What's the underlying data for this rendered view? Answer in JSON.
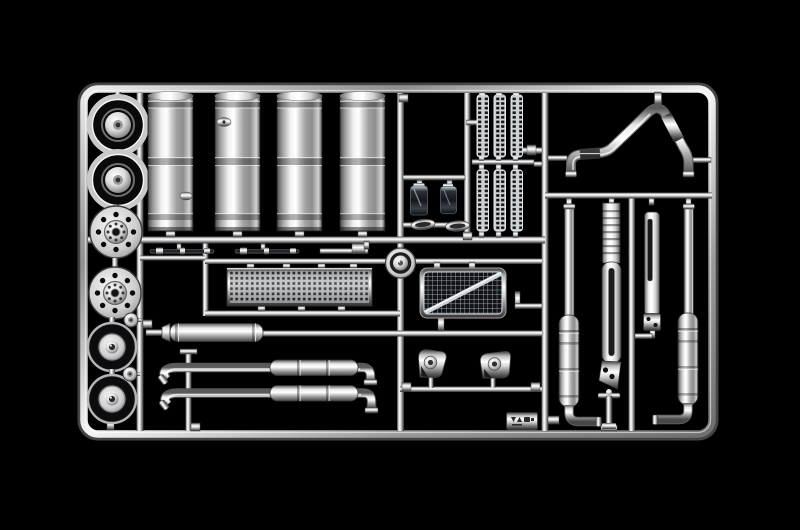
{
  "scene": {
    "type": "photograph",
    "subject": "Chrome-plated injection-moulded model kit sprue (truck detail parts) on a black background",
    "orientation": "overhead, sprue horizontal",
    "lighting": "studio specular highlights on mirror chrome"
  },
  "palette": {
    "background": "#000000",
    "chrome_highlight": "#ffffff",
    "chrome_mid": "#c2c2c2",
    "chrome_shadow": "#3a3a3a",
    "dark_part": "#15161a"
  },
  "parts": [
    {
      "label": "Sprue frame and runners",
      "count": 1,
      "position": "outer rounded rectangle with internal rails"
    },
    {
      "label": "Front wheel covers",
      "count": 2,
      "position": "left column, top"
    },
    {
      "label": "Perforated brake hub covers",
      "count": 2,
      "position": "left column, middle"
    },
    {
      "label": "Rear wheel trims with tyre ring",
      "count": 2,
      "position": "left column, bottom"
    },
    {
      "label": "Small hub caps",
      "count": 2,
      "position": "left column, between lower wheels"
    },
    {
      "label": "Cylindrical fuel tanks",
      "count": 4,
      "position": "upper centre"
    },
    {
      "label": "Perforated exhaust heat-shield strips",
      "count": 6,
      "position": "upper centre-right, two rows of three"
    },
    {
      "label": "Cab step panels",
      "count": 2,
      "position": "centre, dark rectangular parts"
    },
    {
      "label": "Lamp lenses",
      "count": 2,
      "position": "centre, below step panels"
    },
    {
      "label": "Tank end cap",
      "count": 1,
      "position": "centre, round disc"
    },
    {
      "label": "Perforated catwalk plate",
      "count": 1,
      "position": "centre-left band"
    },
    {
      "label": "Trim rods",
      "count": 2,
      "position": "above catwalk plate"
    },
    {
      "label": "Radiator grille with diagonal bar",
      "count": 1,
      "position": "centre, meshed rectangle"
    },
    {
      "label": "Horizontal silencer",
      "count": 1,
      "position": "lower left"
    },
    {
      "label": "Side exhaust pipes with mufflers",
      "count": 2,
      "position": "lower centre, long pipes with curved tips"
    },
    {
      "label": "Wing mirror housings",
      "count": 2,
      "position": "lower centre-right"
    },
    {
      "label": "Curved roof bar Y-pipe",
      "count": 1,
      "position": "upper right"
    },
    {
      "label": "Vertical exhaust stacks with bottom elbows",
      "count": 2,
      "position": "right section"
    },
    {
      "label": "Long exhaust stack shield",
      "count": 1,
      "position": "right section, centre"
    },
    {
      "label": "Short exhaust stack shield",
      "count": 1,
      "position": "right section"
    },
    {
      "label": "T-shaped bracket",
      "count": 1,
      "position": "right section, bottom"
    },
    {
      "label": "Moulded marking tag",
      "count": 1,
      "position": "bottom rail, centre-right"
    }
  ]
}
